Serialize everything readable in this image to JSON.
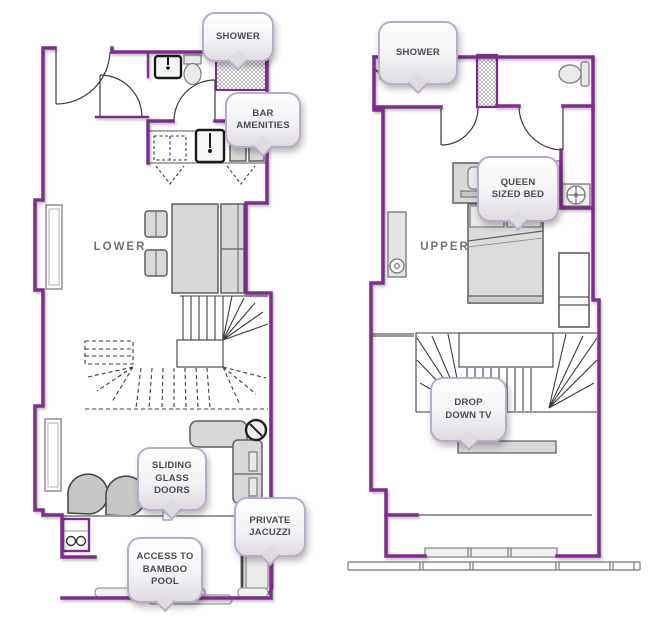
{
  "floor_labels": {
    "lower": "LOWER",
    "upper": "UPPER"
  },
  "callouts": {
    "lower_shower": {
      "label": "SHOWER"
    },
    "bar_amenities": {
      "label": "BAR\nAMENITIES"
    },
    "sliding_glass_doors": {
      "label": "SLIDING\nGLASS\nDOORS"
    },
    "private_jacuzzi": {
      "label": "PRIVATE\nJACUZZI"
    },
    "access_bamboo_pool": {
      "label": "ACCESS TO\nBAMBOO\nPOOL"
    },
    "upper_shower": {
      "label": "SHOWER"
    },
    "queen_sized_bed": {
      "label": "QUEEN\nSIZED BED"
    },
    "drop_down_tv": {
      "label": "DROP\nDOWN TV"
    }
  },
  "colors": {
    "wall": "#7d2d8c",
    "callout_border": "#bcaacb",
    "callout_fill_top": "#ffffff",
    "callout_fill_bottom": "#dedce1",
    "callout_text": "#4b4b50",
    "floor_label_text": "#737373",
    "furniture": "#d8d8d8"
  }
}
